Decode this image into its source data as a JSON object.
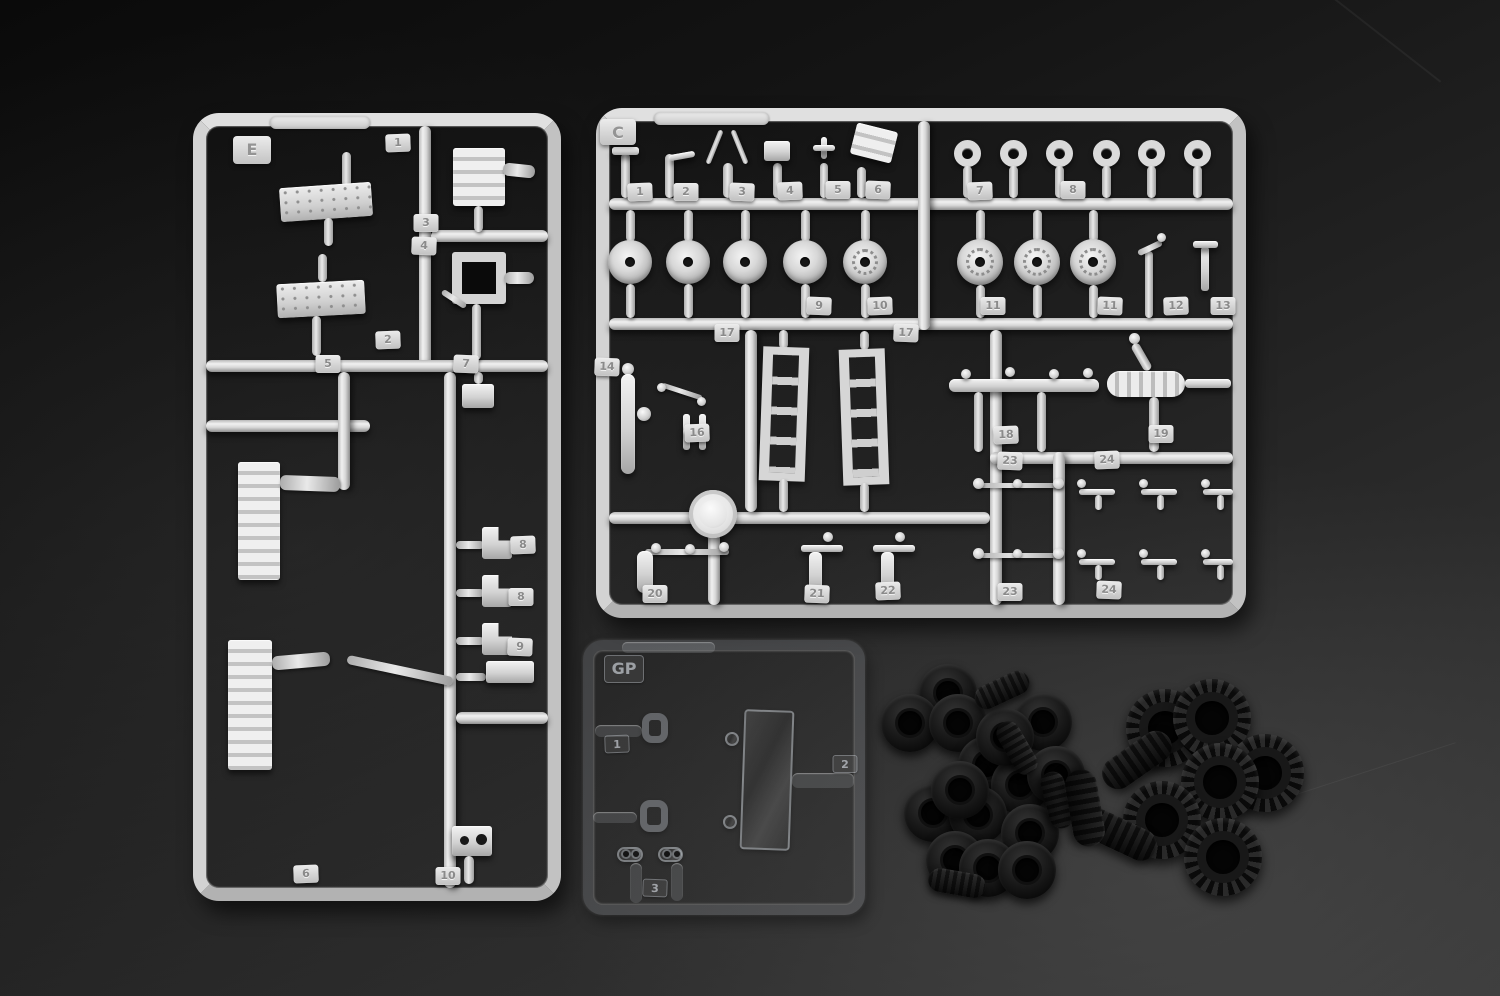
{
  "scene": {
    "description": "Photograph of injection-molded model kit sprues and rubber tires on a dark studio surface"
  },
  "colors": {
    "background_top": "#0a0a0a",
    "background_bottom": "#3a3a3a",
    "plastic_gray": "#d6d6d6",
    "plastic_shadow": "#8e8e8e",
    "clear_plastic_edge": "rgba(225,232,242,0.35)",
    "tire_black": "#141414"
  },
  "sprue_e": {
    "letter": "E",
    "part_tags": [
      "1",
      "3",
      "4",
      "2",
      "5",
      "7",
      "8",
      "8",
      "9",
      "6",
      "10"
    ]
  },
  "sprue_c": {
    "letter": "C",
    "part_tags": [
      "1",
      "2",
      "3",
      "4",
      "5",
      "6",
      "7",
      "8",
      "9",
      "10",
      "11",
      "11",
      "12",
      "13",
      "14",
      "16",
      "17",
      "17",
      "18",
      "19",
      "23",
      "24",
      "20",
      "21",
      "22",
      "23",
      "24"
    ]
  },
  "sprue_gp": {
    "letter": "GP",
    "part_tags": [
      "1",
      "2",
      "3"
    ]
  },
  "tires": {
    "small_pile_count": 19,
    "large_pile_count": 9
  }
}
